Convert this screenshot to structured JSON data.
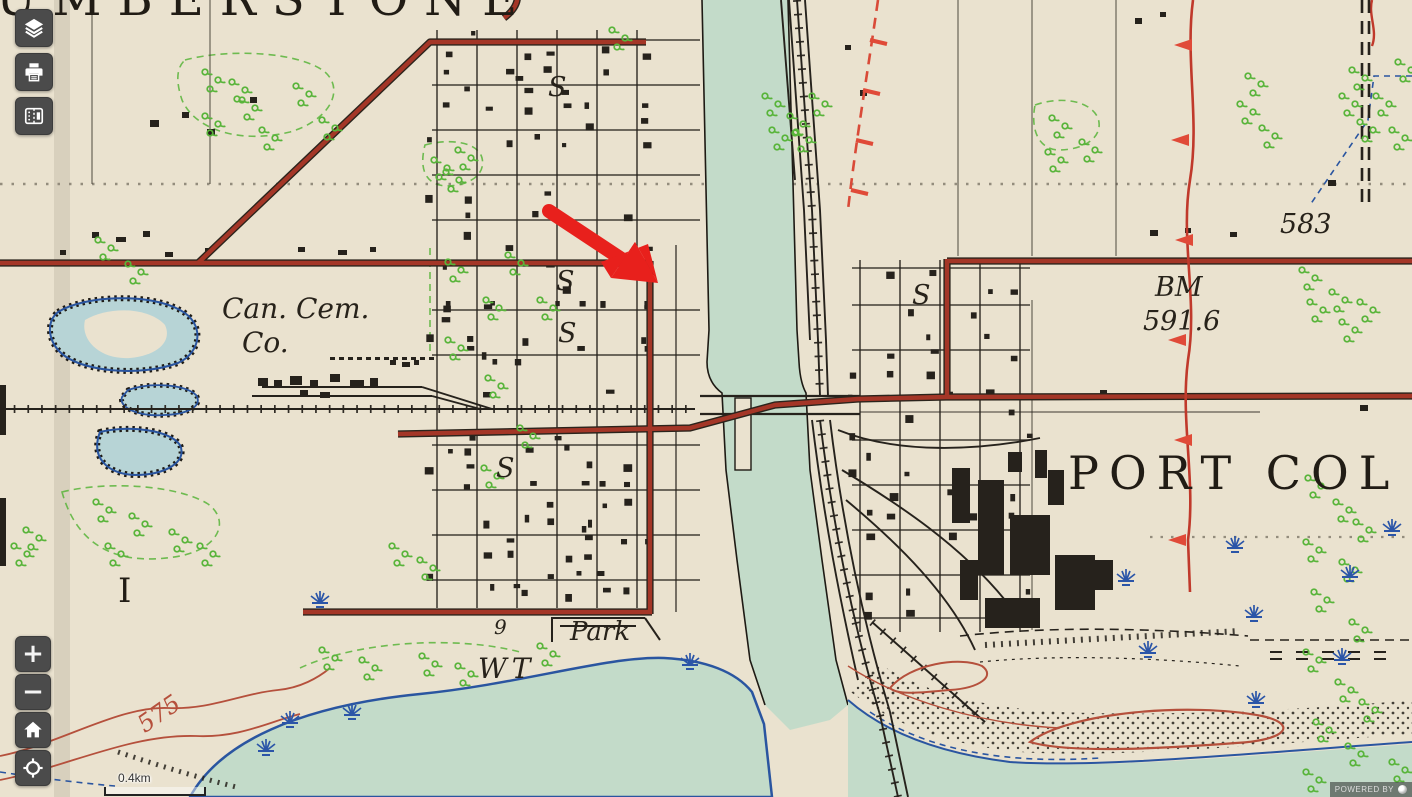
{
  "ui": {
    "toolbar": [
      {
        "id": "layers",
        "icon": "layers-icon"
      },
      {
        "id": "print",
        "icon": "printer-icon"
      },
      {
        "id": "compare",
        "icon": "compare-maps-icon"
      }
    ],
    "zoom_in_label": "+",
    "zoom_out_label": "−",
    "home_icon": "home-icon",
    "locate_icon": "locate-icon",
    "scale_label": "0.4km",
    "powered_by": "POWERED BY"
  },
  "map": {
    "labels": {
      "town_top": "HUMBERSTONE",
      "town_right": "PORT COL",
      "cemetery_line1": "Can. Cem.",
      "cemetery_line2": "Co.",
      "benchmark_line1": "BM",
      "benchmark_line2": "591.6",
      "elevation_583": "583",
      "contour_575": "575",
      "park": "Park",
      "water_tower": "WT",
      "lot_I": "I",
      "school_s": "S",
      "nine": "9"
    },
    "colors": {
      "paper": "#eae2cf",
      "water": "#c3dbc9",
      "pond": "#b7d4d6",
      "shoreline": "#2a55a0",
      "road_red": "#a43627",
      "vegetation_green": "#58b43a",
      "contour_red": "#b5503c",
      "ink_black": "#26221c",
      "arrow_red": "#e8201c"
    },
    "annotation": {
      "type": "arrow",
      "color": "#e8201c"
    }
  }
}
